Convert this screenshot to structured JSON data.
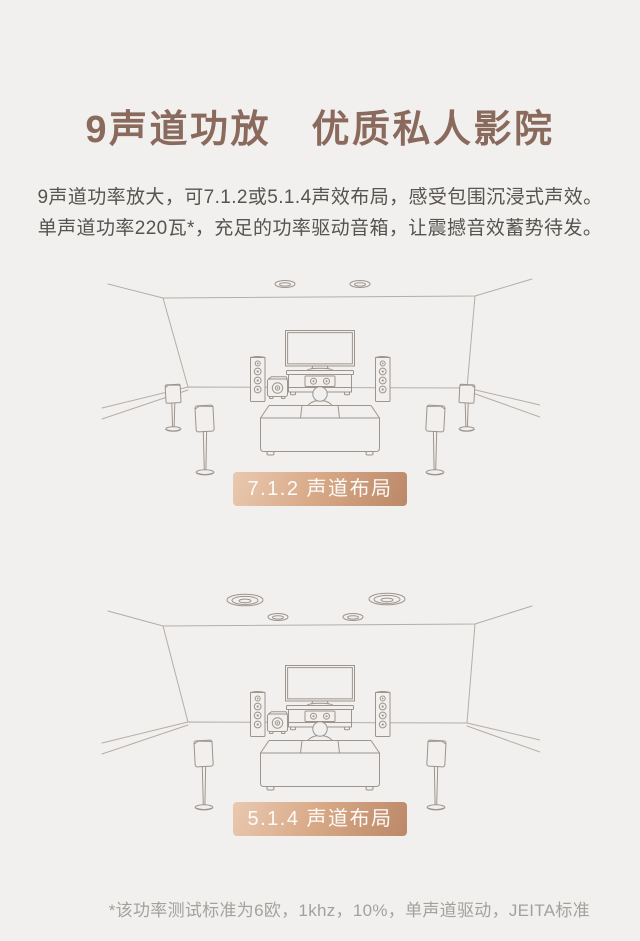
{
  "page": {
    "title": "9声道功放　优质私人影院",
    "subtitle_lines": [
      "9声道功率放大，可7.1.2或5.1.4声效布局，感受包围沉浸式声效。",
      "单声道功率220瓦*，充足的功率驱动音箱，让震撼音效蓄势待发。"
    ],
    "footnote": "*该功率测试标准为6欧，1khz，10%，单声道驱动，JEITA标准"
  },
  "diagrams": [
    {
      "layout": "7.1.2",
      "label": "7.1.2 声道布局",
      "ceiling_speakers": 2,
      "side_surround_speakers": 2,
      "rear_surround_speakers": 2,
      "tower_speakers": 2,
      "center_speaker": 1,
      "subwoofer": 1
    },
    {
      "layout": "5.1.4",
      "label": "5.1.4 声道布局",
      "ceiling_speakers": 4,
      "side_surround_speakers": 0,
      "rear_surround_speakers": 2,
      "tower_speakers": 2,
      "center_speaker": 1,
      "subwoofer": 1
    }
  ],
  "colors": {
    "background": "#f1f0ee",
    "accent_text": "#8b6a5e",
    "body_text": "#57534f",
    "line_art": "#9d948d",
    "line_soft": "#b5ada6",
    "badge_text": "#fdfbf9",
    "badge_grad_light": "#e9c9b0",
    "badge_grad_mid": "#d8a987",
    "badge_grad_dark": "#bb8868",
    "footnote_text": "#a4a19d"
  }
}
